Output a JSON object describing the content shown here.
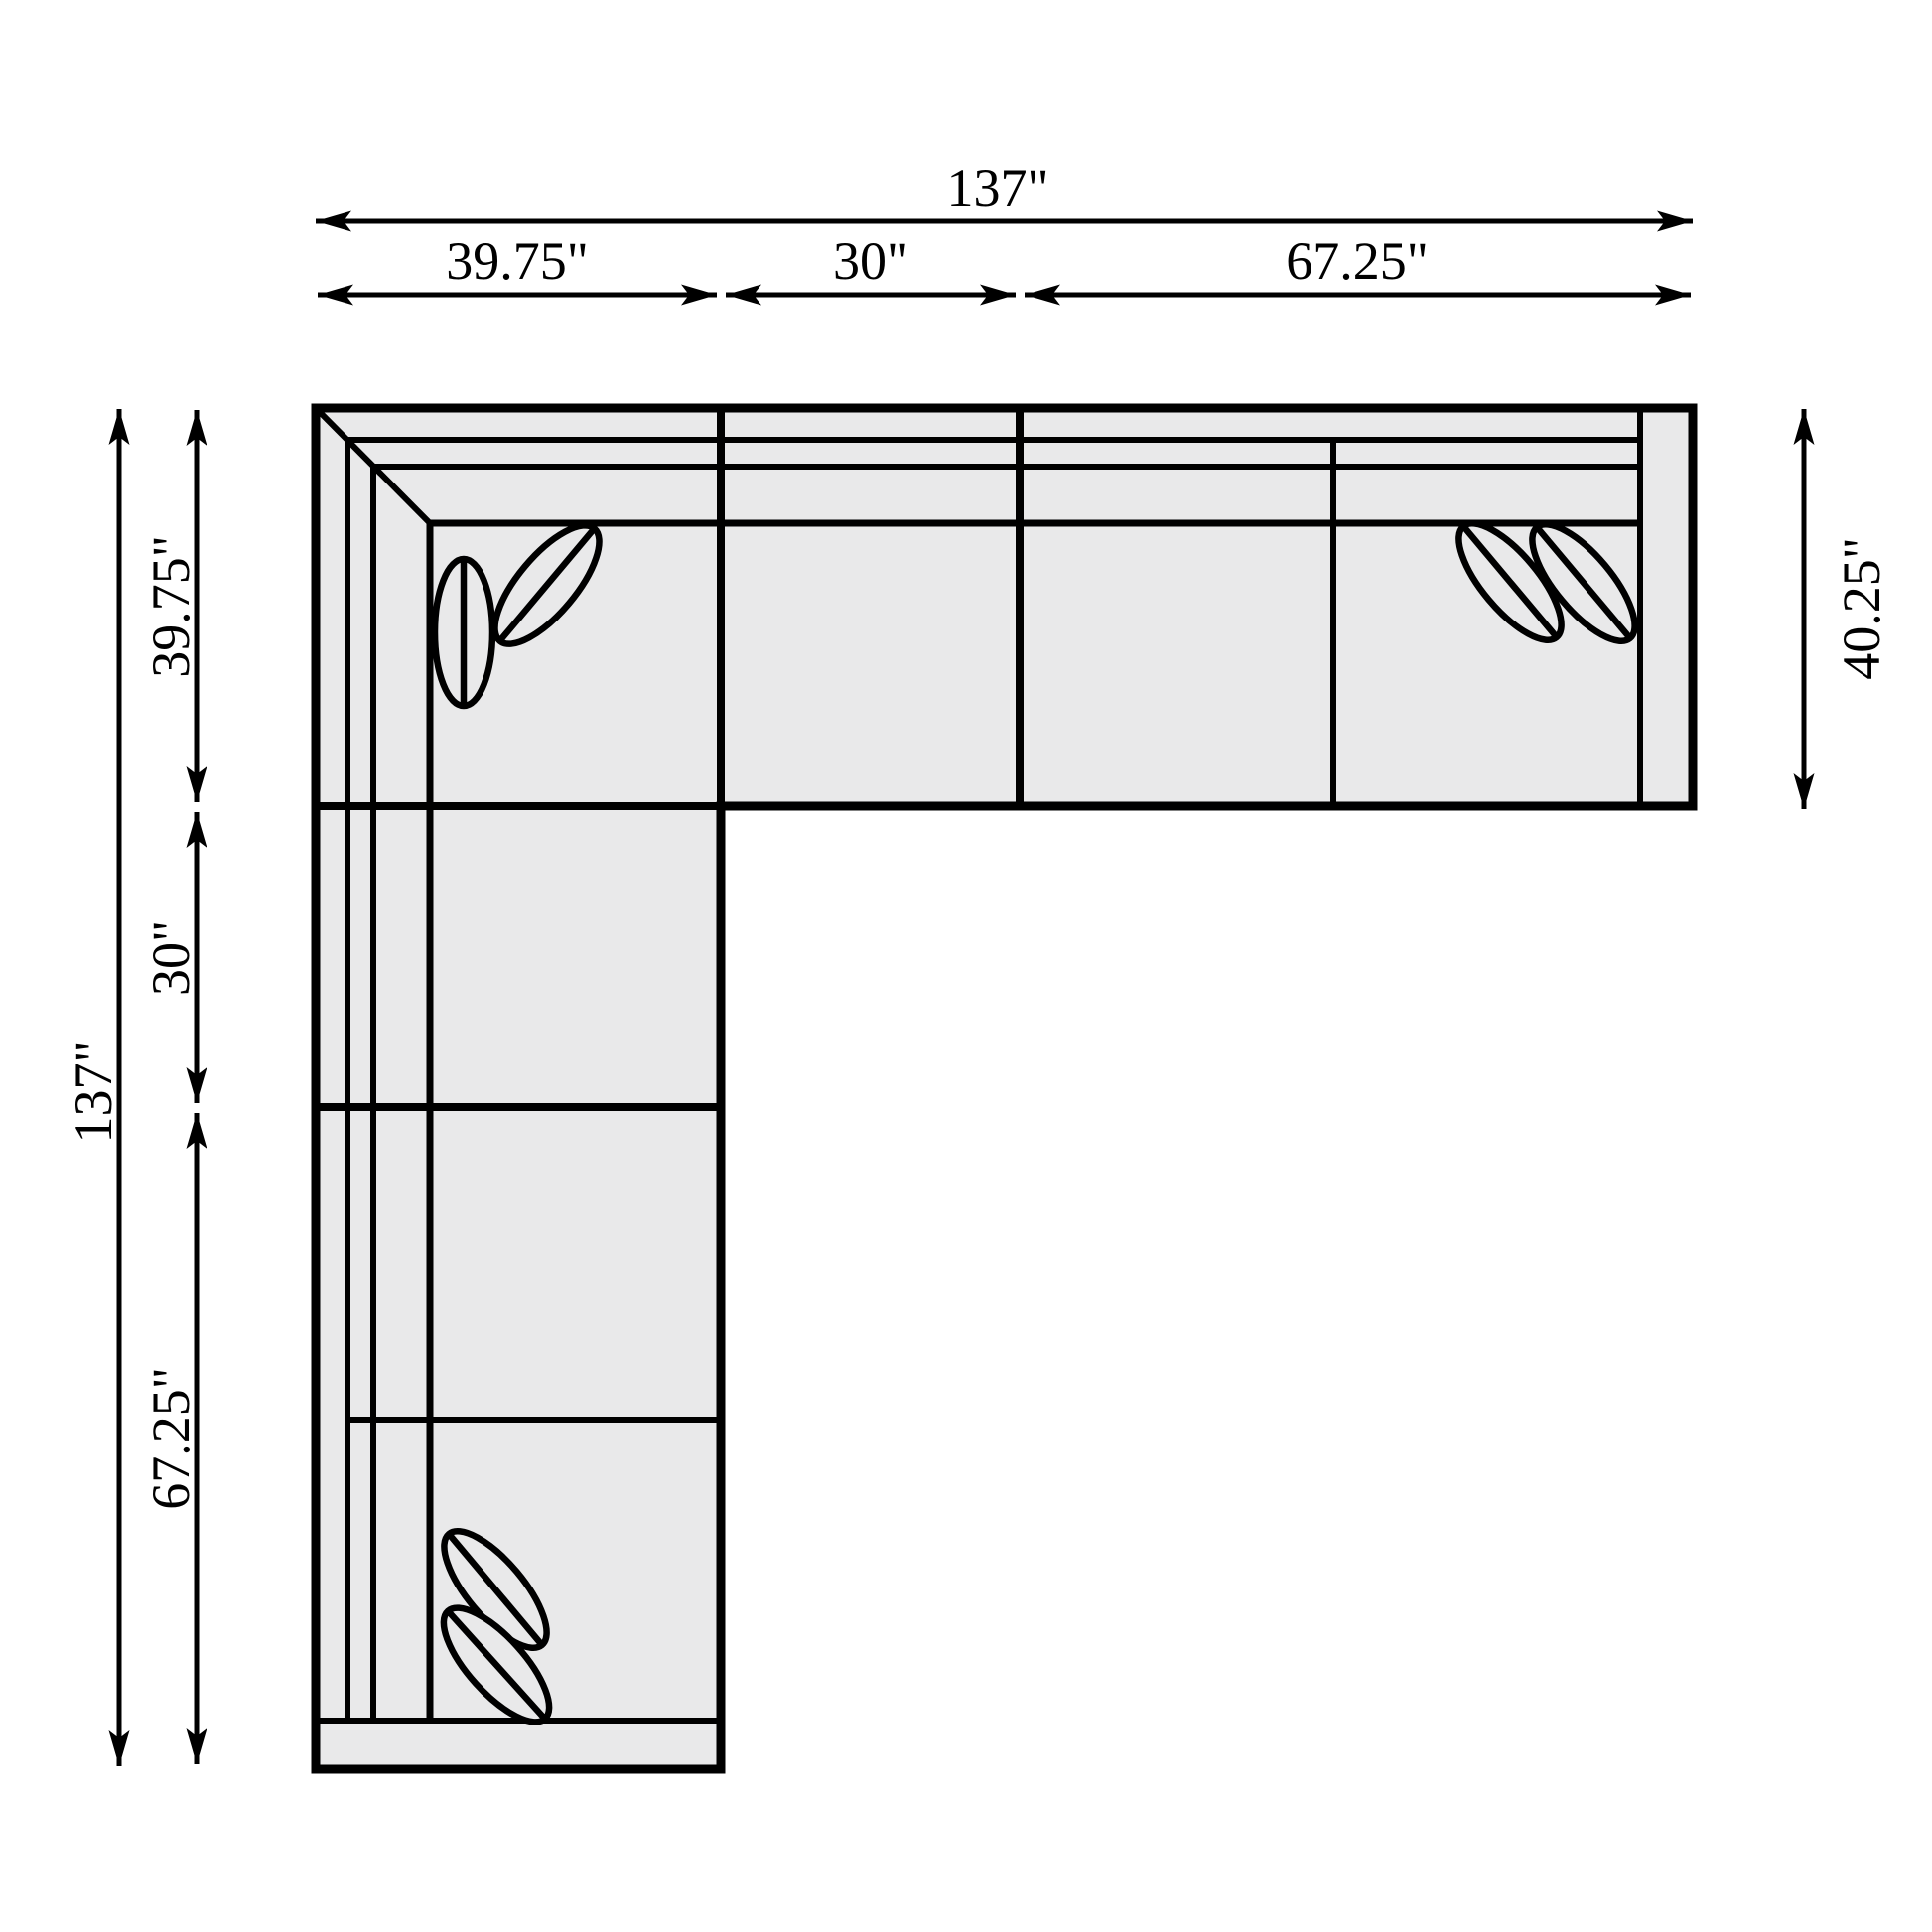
{
  "diagram": {
    "title": "sectional-sofa-floor-plan",
    "colors": {
      "background": "#ffffff",
      "sofa_fill": "#e9e9ea",
      "line": "#000000"
    },
    "dims": {
      "top_total": "137\"",
      "top_seg1": "39.75\"",
      "top_seg2": "30\"",
      "top_seg3": "67.25\"",
      "left_total": "137\"",
      "left_seg1": "39.75\"",
      "left_seg2": "30\"",
      "left_seg3": "67.25\"",
      "right_depth": "40.25\""
    },
    "values_inches": {
      "overall_width": 137,
      "overall_depth": 137,
      "chaise_depth": 40.25,
      "top_segments": [
        39.75,
        30,
        67.25
      ],
      "left_segments": [
        39.75,
        30,
        67.25
      ]
    }
  }
}
